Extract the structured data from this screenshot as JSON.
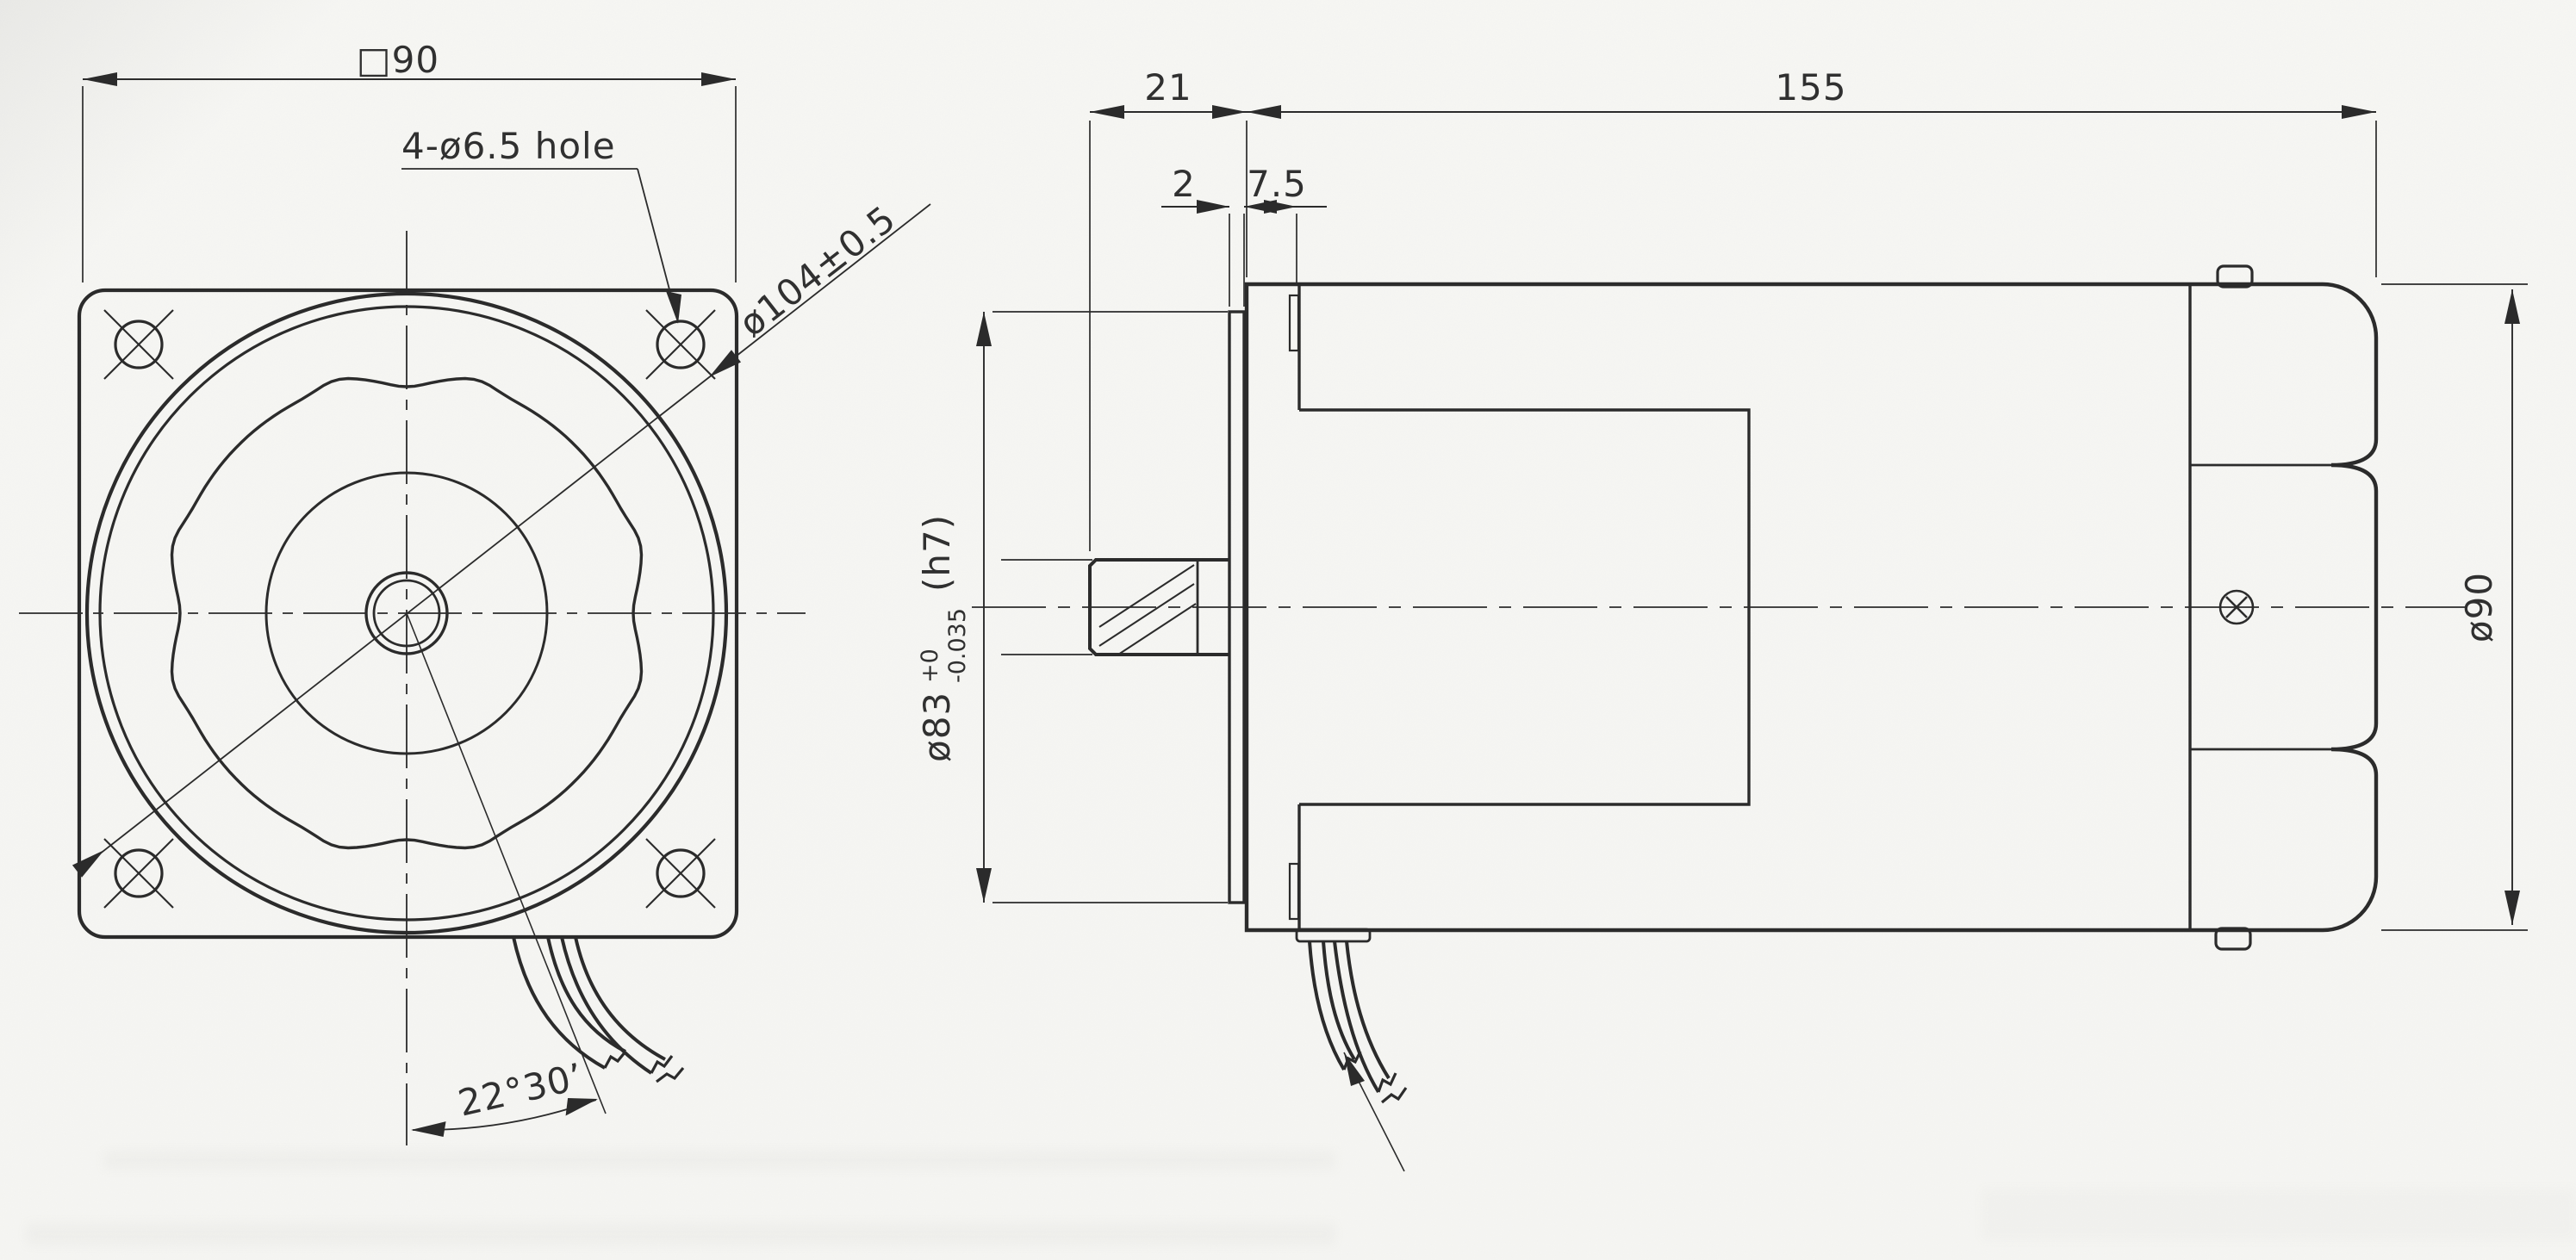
{
  "drawing": {
    "front_view": {
      "square_dim": "□90",
      "holes_label": "4-ø6.5 hole",
      "bolt_circle_dim": "ø104±0.5",
      "angle_dim": "22°30’"
    },
    "side_view": {
      "shaft_ext_dim": "21",
      "body_length_dim": "155",
      "plate_thickness_dim": "2",
      "boss_depth_dim": "7.5",
      "spigot_dia_main": "ø83",
      "spigot_dia_tol_upper": "+0",
      "spigot_dia_tol_lower": "-0.035",
      "spigot_dia_fit": "(h7)",
      "body_dia_dim": "ø90"
    },
    "colors": {
      "line": "#2b2b2b",
      "paper": "#f6f6f3"
    }
  }
}
